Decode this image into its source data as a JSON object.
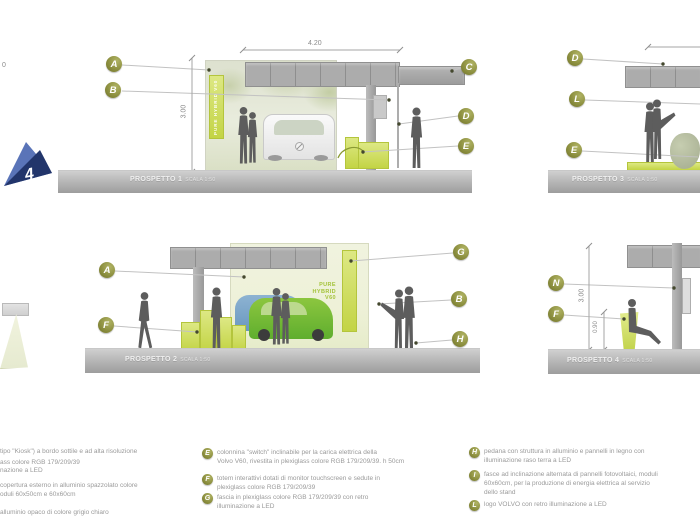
{
  "misc": {
    "stray_text": "0",
    "page_marker": "4"
  },
  "colors": {
    "accent_green": "#b3d127",
    "olive": "#8d9040",
    "roof_gray": "#a9a9a9"
  },
  "elevations": {
    "p1": {
      "title": "PROSPETTO 1",
      "scale": "SCALA 1:50",
      "width_dim": "4.20",
      "height_dim": "3.00",
      "sign_text": "PURE HYBRID V60",
      "callouts": {
        "a": "A",
        "b": "B",
        "c": "C",
        "d": "D",
        "e": "E"
      }
    },
    "p2": {
      "title": "PROSPETTO 2",
      "scale": "SCALA 1:50",
      "caption": [
        "PURE",
        "HYBRID",
        "V60"
      ],
      "callouts": {
        "a": "A",
        "f": "F",
        "g": "G",
        "b": "B",
        "h": "H"
      }
    },
    "p3": {
      "title": "PROSPETTO 3",
      "scale": "SCALA 1:50",
      "callouts": {
        "d": "D",
        "l": "L",
        "e": "E"
      }
    },
    "p4": {
      "title": "PROSPETTO 4",
      "scale": "SCALA 1:50",
      "height_dim": "3.00",
      "seat_dim": "0.90",
      "callouts": {
        "n": "N",
        "f": "F"
      }
    }
  },
  "legend": {
    "left_fragments": [
      "tipo \"Kiosk\") a bordo sottile e ad alta risoluzione",
      "ass colore RGB 179/209/39",
      "nazione a LED",
      "copertura esterno in alluminio spazzolato colore",
      "oduli 60x50cm e 60x60cm",
      "alluminio opaco di colore grigio chiaro"
    ],
    "middle": [
      {
        "letter": "E",
        "lines": [
          "colonnina \"switch\" inclinabile per la carica elettrica della",
          "Volvo V60, rivestita in plexiglass colore RGB 179/209/39. h 50cm"
        ]
      },
      {
        "letter": "F",
        "lines": [
          "totem interattivi dotati di monitor touchscreen e sedute in",
          "plexiglass colore RGB 179/209/39"
        ]
      },
      {
        "letter": "G",
        "lines": [
          "fascia in plexiglass colore RGB 179/209/39 con retro",
          "illuminazione a LED"
        ]
      }
    ],
    "right": [
      {
        "letter": "H",
        "lines": [
          "pedana con struttura in alluminio e pannelli in legno con",
          "illuminazione raso terra a LED"
        ]
      },
      {
        "letter": "I",
        "lines": [
          "fasce ad inclinazione alternata di pannelli fotovoltaici, moduli",
          "60x60cm, per la produzione di energia elettrica al servizio",
          "dello stand"
        ]
      },
      {
        "letter": "L",
        "lines": [
          "logo VOLVO con retro illuminazione a LED"
        ]
      }
    ]
  }
}
